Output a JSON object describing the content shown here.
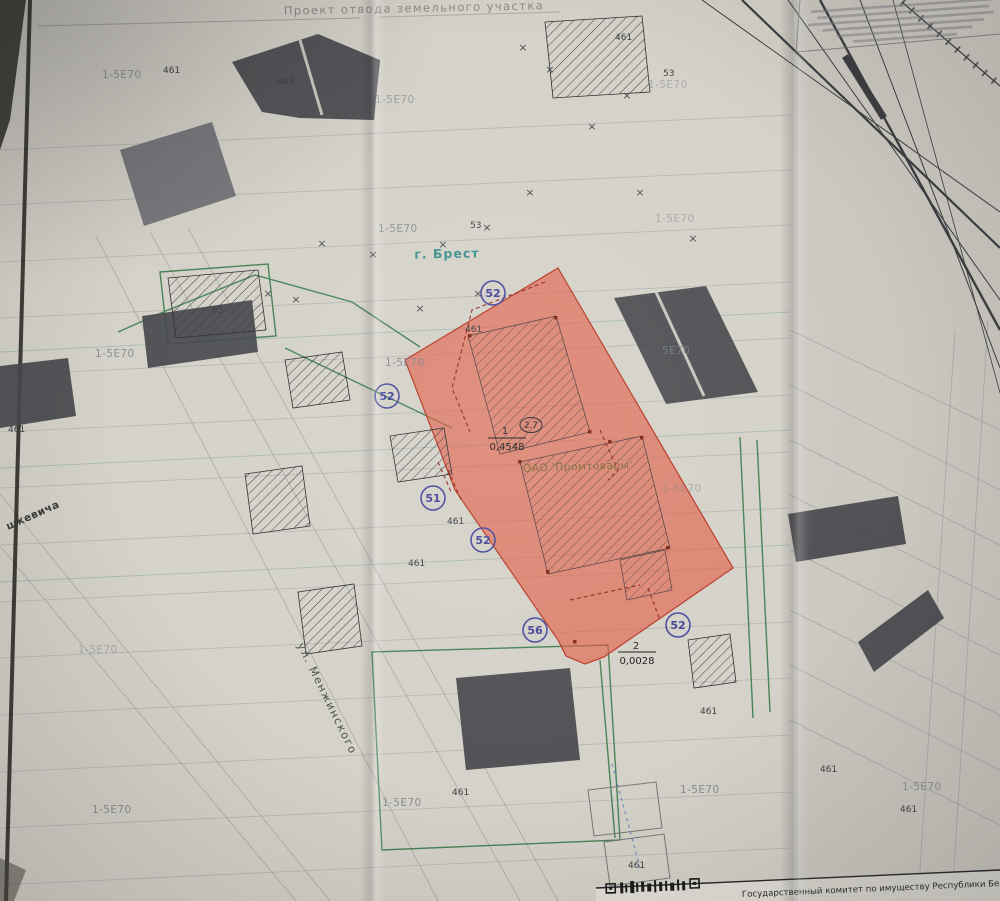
{
  "title": "Проект отвода земельного участка",
  "footer": {
    "agency": "Государственный комитет по имуществу Республики Беларусь"
  },
  "map": {
    "city": "г. Брест",
    "company": "ОАО 'Промтовары'",
    "street_1": "ул. Менжинского",
    "street_2": "шкевича",
    "parcel_main": {
      "num": "1",
      "area": "0,4548"
    },
    "parcel_extra": {
      "num": "2",
      "area": "0,0028"
    },
    "elevation": "2.7",
    "survey_points": [
      {
        "label": "52",
        "x": 493,
        "y": 293
      },
      {
        "label": "52",
        "x": 387,
        "y": 396
      },
      {
        "label": "51",
        "x": 433,
        "y": 498
      },
      {
        "label": "52",
        "x": 483,
        "y": 540
      },
      {
        "label": "56",
        "x": 535,
        "y": 630
      },
      {
        "label": "52",
        "x": 678,
        "y": 625
      }
    ],
    "zone_labels": [
      {
        "text": "1-5Е70",
        "x": 102,
        "y": 78,
        "o": 0.8
      },
      {
        "text": "1-5Е70",
        "x": 375,
        "y": 103,
        "o": 0.65
      },
      {
        "text": "1-5Е70",
        "x": 378,
        "y": 232,
        "o": 0.8
      },
      {
        "text": "1-5Е70",
        "x": 95,
        "y": 357,
        "o": 0.85
      },
      {
        "text": "1-5Е70",
        "x": 385,
        "y": 366,
        "o": 0.85
      },
      {
        "text": "1-5Е70",
        "x": 648,
        "y": 88,
        "o": 0.45
      },
      {
        "text": "1-5Е70",
        "x": 655,
        "y": 222,
        "o": 0.5
      },
      {
        "text": "5Е70",
        "x": 662,
        "y": 354,
        "o": 0.8
      },
      {
        "text": "1-5Е70",
        "x": 662,
        "y": 492,
        "o": 0.45
      },
      {
        "text": "1-5Е70",
        "x": 78,
        "y": 653,
        "o": 0.5
      },
      {
        "text": "1-5Е70",
        "x": 92,
        "y": 813,
        "o": 0.85
      },
      {
        "text": "1-5Е70",
        "x": 382,
        "y": 806,
        "o": 0.85
      },
      {
        "text": "1-5Е70",
        "x": 680,
        "y": 793,
        "o": 0.85
      },
      {
        "text": "1-5Е70",
        "x": 902,
        "y": 790,
        "o": 0.75
      }
    ],
    "small_labels": [
      {
        "text": "461",
        "x": 163,
        "y": 73
      },
      {
        "text": "461",
        "x": 277,
        "y": 84
      },
      {
        "text": "461",
        "x": 615,
        "y": 40
      },
      {
        "text": "63",
        "x": 212,
        "y": 313
      },
      {
        "text": "53",
        "x": 470,
        "y": 228
      },
      {
        "text": "53",
        "x": 663,
        "y": 76
      },
      {
        "text": "461",
        "x": 465,
        "y": 332
      },
      {
        "text": "461",
        "x": 8,
        "y": 432
      },
      {
        "text": "461",
        "x": 447,
        "y": 524
      },
      {
        "text": "461",
        "x": 408,
        "y": 566
      },
      {
        "text": "461",
        "x": 700,
        "y": 714
      },
      {
        "text": "461",
        "x": 452,
        "y": 795
      },
      {
        "text": "461",
        "x": 820,
        "y": 772
      },
      {
        "text": "461",
        "x": 900,
        "y": 812
      },
      {
        "text": "461",
        "x": 628,
        "y": 868
      }
    ],
    "cross_marks": [
      {
        "x": 523,
        "y": 51
      },
      {
        "x": 550,
        "y": 73
      },
      {
        "x": 627,
        "y": 99
      },
      {
        "x": 592,
        "y": 130
      },
      {
        "x": 640,
        "y": 196
      },
      {
        "x": 530,
        "y": 196
      },
      {
        "x": 322,
        "y": 247
      },
      {
        "x": 373,
        "y": 258
      },
      {
        "x": 443,
        "y": 248
      },
      {
        "x": 487,
        "y": 231
      },
      {
        "x": 268,
        "y": 297
      },
      {
        "x": 296,
        "y": 303
      },
      {
        "x": 478,
        "y": 297
      },
      {
        "x": 420,
        "y": 312
      },
      {
        "x": 693,
        "y": 242
      }
    ],
    "colors": {
      "parcel_fill": "#e25a43",
      "boundary_green": "#2e7743",
      "ink_blue": "#4b4b9e",
      "city_teal": "#3f9090"
    }
  }
}
